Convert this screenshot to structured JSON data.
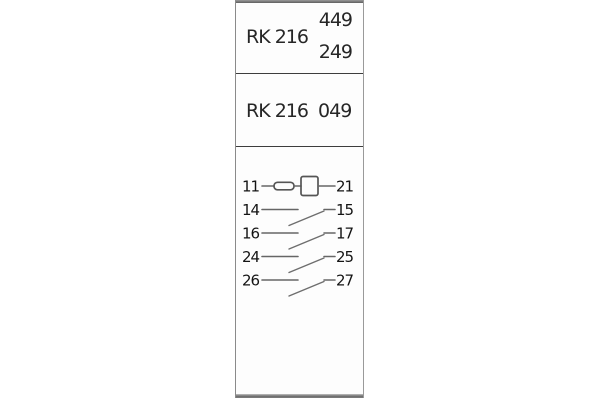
{
  "panel": {
    "section1": {
      "model": "RK 216",
      "code_top": "449",
      "code_bottom": "249"
    },
    "section2": {
      "label": "RK 216  049"
    },
    "diagram": {
      "rows": [
        {
          "left": "11",
          "right": "21",
          "type": "coil"
        },
        {
          "left": "14",
          "right": "15",
          "type": "contact"
        },
        {
          "left": "16",
          "right": "17",
          "type": "contact"
        },
        {
          "left": "24",
          "right": "25",
          "type": "contact"
        },
        {
          "left": "26",
          "right": "27",
          "type": "contact"
        }
      ]
    },
    "colors": {
      "background": "#ffffff",
      "panel_fill": "#fdfdfd",
      "panel_border": "#8a8a8a",
      "top_band": "#6f6f6f",
      "bottom_band": "#7d7d7d",
      "divider": "#3d3d3d",
      "header_text": "#262626",
      "diagram_text": "#141414",
      "diagram_line": "#666666"
    }
  }
}
